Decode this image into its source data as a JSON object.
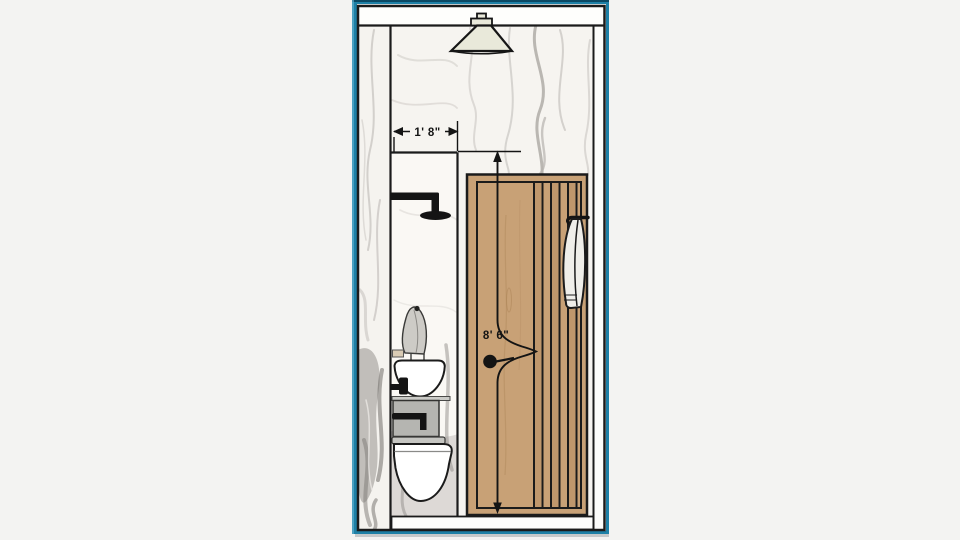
{
  "view": {
    "name": "bathroom-elevation-section-drawing",
    "background_color": "#f3f3f2",
    "frame_color": "#1e80a6",
    "page_color": "#ffffff"
  },
  "dimensions": {
    "shower_width": "1' 8\"",
    "room_height": "8' 6\""
  },
  "colors": {
    "door_wood": "#c8a176",
    "lamp_shade": "#e9e9da",
    "vanity_gray": "#b5b5b1",
    "towel_white": "#efeee9",
    "line_ink": "#1b1b1b",
    "marble_base": "#f6f4f0"
  }
}
